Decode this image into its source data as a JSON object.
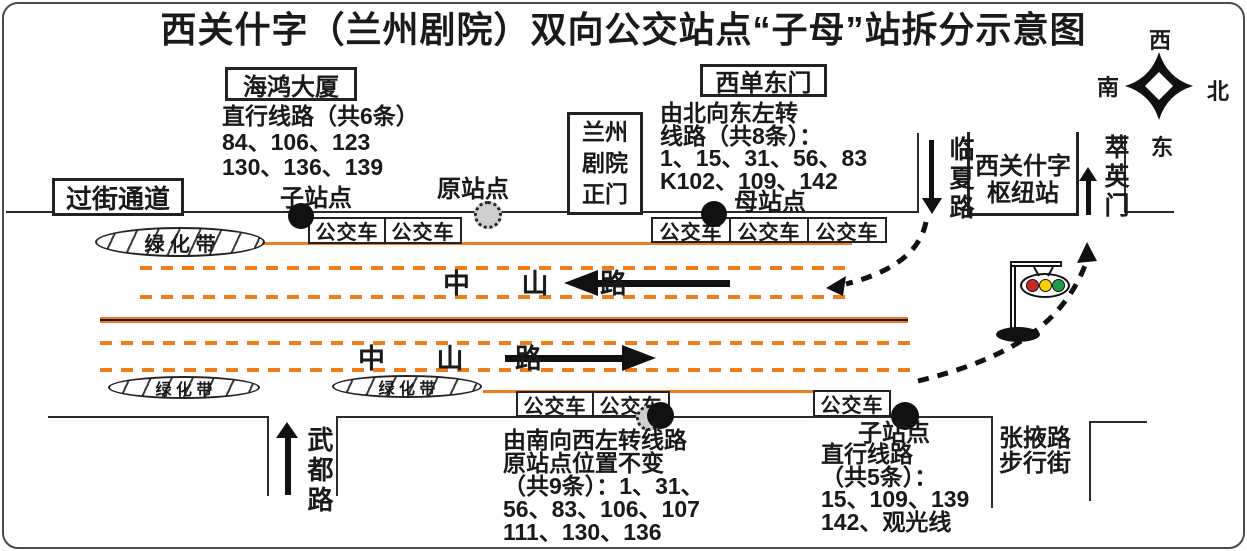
{
  "title": "西关什字（兰州剧院）双向公交站点“子母”站拆分示意图",
  "compass": {
    "west": "西",
    "south": "南",
    "north": "北",
    "east": "东"
  },
  "places": {
    "haihong": "海鸿大厦",
    "crossing": "过街通道",
    "xidan": "西单东门",
    "theater": [
      "兰州",
      "剧院",
      "正门"
    ],
    "hub": [
      "西关什字",
      "枢纽站"
    ],
    "zhangye": [
      "张掖路",
      "步行街"
    ]
  },
  "roads": {
    "zhongshan_upper": "中 山 路",
    "zhongshan_lower": "中 山 路",
    "linxia": "临夏路",
    "cuiying": "萃英门",
    "wudu": "武都路"
  },
  "markers": {
    "bus": "公交车",
    "greenbelt": "绿 化 带",
    "sub_top": "子站点",
    "orig_top": "原站点",
    "mother": "母站点",
    "sub_bottom": "子站点"
  },
  "notes": {
    "haihong_routes": [
      "直行线路（共6条）",
      "84、106、123",
      "130、136、139"
    ],
    "north_turn": [
      "由北向东左转",
      "线路（共8条）：",
      "1、15、31、56、83",
      "K102、109、142"
    ],
    "south_turn": [
      "由南向西左转线路",
      "原站点位置不变",
      "（共9条）：1、31、",
      "56、83、106、107",
      "111、130、136"
    ],
    "straight_south": [
      "直行线路",
      "（共5条）：",
      "15、109、139",
      "142、观光线"
    ]
  },
  "colors": {
    "lane_orange": "#ef7d1a",
    "ink": "#1a1a1a",
    "signal_red": "#cc2727",
    "signal_yellow": "#fdd000",
    "signal_green": "#1b9e45"
  }
}
